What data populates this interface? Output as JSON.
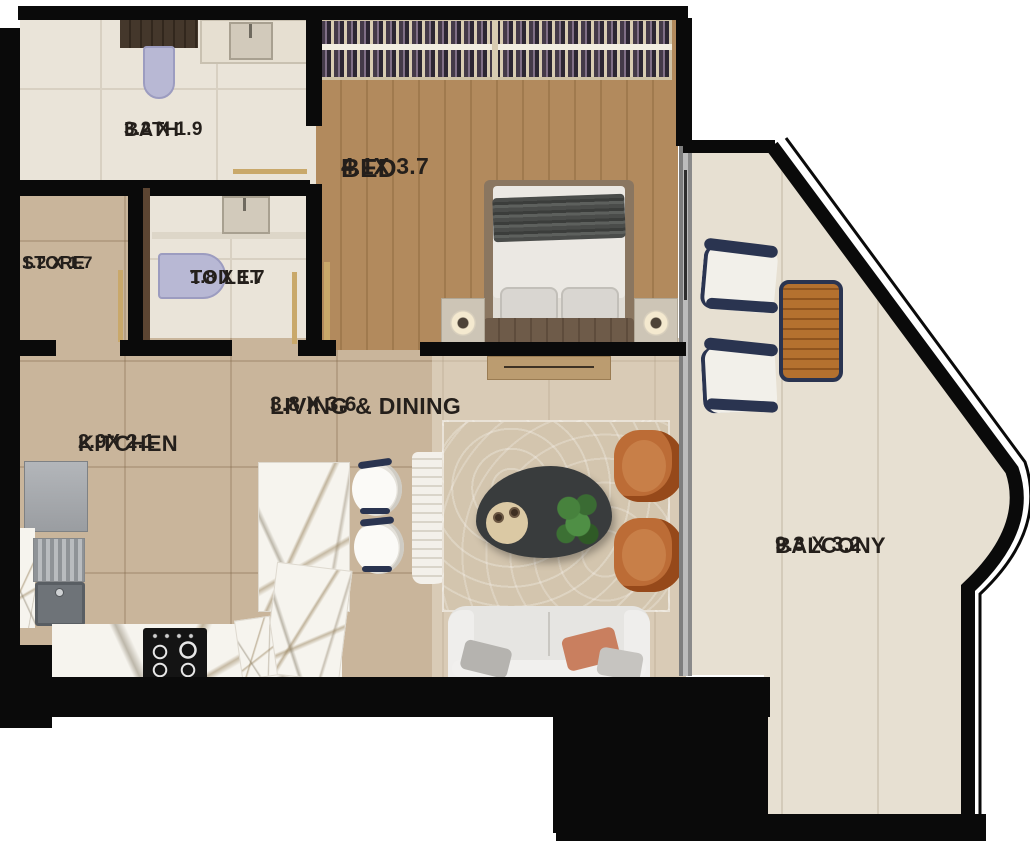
{
  "floorplan": {
    "type": "apartment-floor-plan",
    "rooms": [
      {
        "id": "bath",
        "name": "BATH",
        "dims": "3.2 X 1.9"
      },
      {
        "id": "bed",
        "name": "BED",
        "dims": "4.1X 3.7"
      },
      {
        "id": "store",
        "name": "STORE",
        "dims": "1.2 X 1.7"
      },
      {
        "id": "toilet",
        "name": "TOILET",
        "dims": "1.8 X 1.7"
      },
      {
        "id": "living",
        "name": "LIVING & DINING",
        "dims": "3.8 X 3.6"
      },
      {
        "id": "kitchen",
        "name": "KITCHEN",
        "dims": "2.9X 2.1"
      },
      {
        "id": "balcony",
        "name": "BALCONY",
        "dims": "9.3 X 3.2"
      }
    ],
    "furniture": [
      "wardrobe-hanging-clothes",
      "double-bed",
      "nightstand-left",
      "nightstand-right",
      "bedside-lamps",
      "tv-console",
      "bath-cabinet",
      "bath-toilet",
      "bath-vanity-sink",
      "toilet-wc",
      "toilet-basin",
      "refrigerator",
      "kitchen-sink",
      "gas-hob",
      "marble-counter",
      "marble-island",
      "bar-stools",
      "ribbed-runner",
      "area-rug",
      "coffee-table",
      "serving-tray",
      "potted-plant",
      "accent-armchairs",
      "sofa",
      "outdoor-chairs",
      "outdoor-slatted-table",
      "sliding-glass-door"
    ],
    "colors": {
      "wall": "#0a0a0a",
      "wood_floor": "#b28a5d",
      "tile_floor": "#c9b59b",
      "stone_floor": "#eae4d9",
      "balcony_floor": "#e7e0d2",
      "marble": "#f6f4ee",
      "accent_orange": "#bc6c36",
      "navy": "#2a3450",
      "lavender_fixture": "#b8b8d4",
      "door_swing_gold": "#c9a86a",
      "label_text": "#241f1b"
    }
  }
}
